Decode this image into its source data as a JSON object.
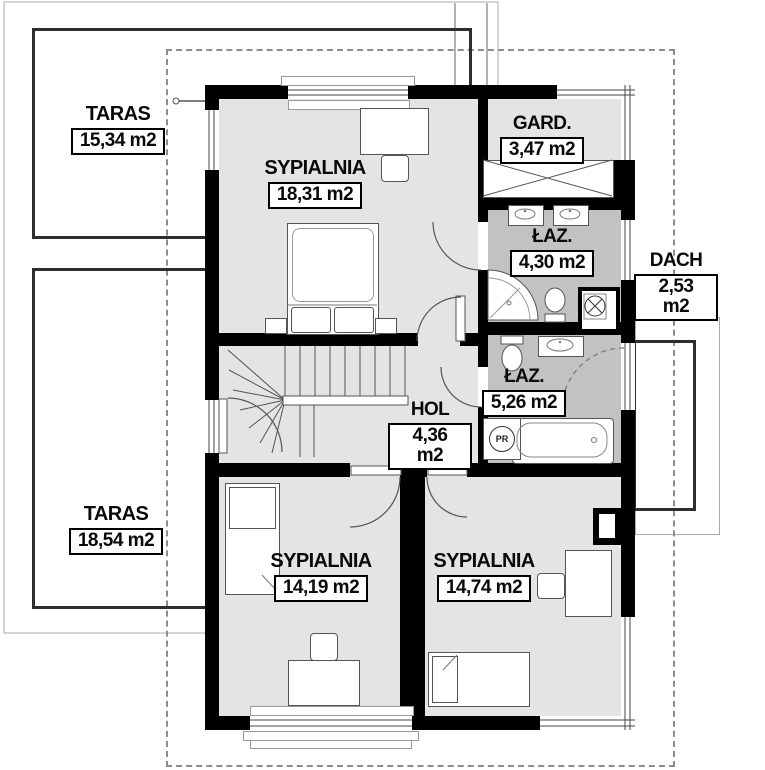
{
  "plan_title": "floor-plan-upper-storey",
  "rooms": [
    {
      "id": "taras-top",
      "name": "TARAS",
      "area": "15,34 m2"
    },
    {
      "id": "sypialnia-master",
      "name": "SYPIALNIA",
      "area": "18,31 m2"
    },
    {
      "id": "garderoba",
      "name": "GARD.",
      "area": "3,47 m2"
    },
    {
      "id": "lazienka-upper",
      "name": "ŁAZ.",
      "area": "4,30 m2"
    },
    {
      "id": "dach",
      "name": "DACH",
      "area": "2,53 m2"
    },
    {
      "id": "lazienka-lower",
      "name": "ŁAZ.",
      "area": "5,26 m2"
    },
    {
      "id": "hol",
      "name": "HOL",
      "area": "4,36 m2"
    },
    {
      "id": "taras-left",
      "name": "TARAS",
      "area": "18,54 m2"
    },
    {
      "id": "sypialnia-left",
      "name": "SYPIALNIA",
      "area": "14,19 m2"
    },
    {
      "id": "sypialnia-right",
      "name": "SYPIALNIA",
      "area": "14,74 m2"
    }
  ],
  "markers": {
    "pr": "PR"
  },
  "colors": {
    "wall": "#000000",
    "room_floor": "#e4e4e4",
    "bath_floor": "#c2c2c2",
    "roof_dash": "#8d8d8d",
    "railing": "#2e2e2e"
  }
}
